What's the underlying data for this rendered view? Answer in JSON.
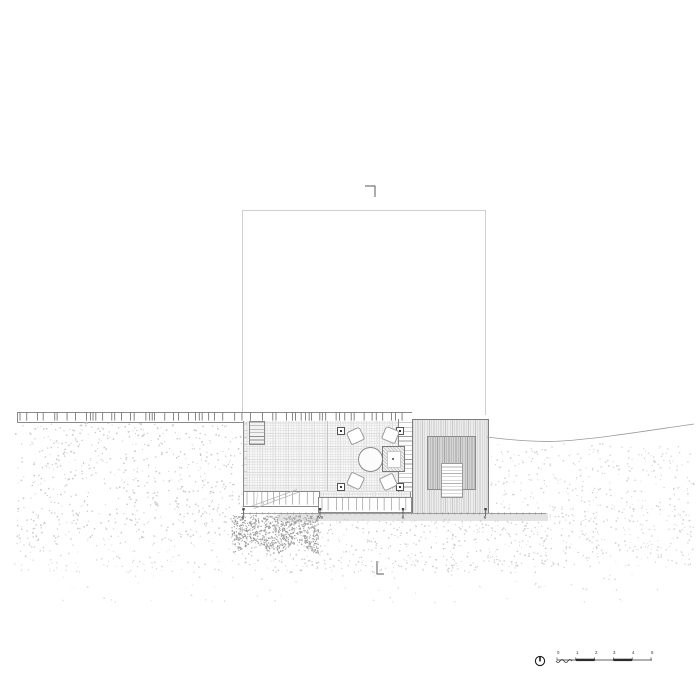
{
  "drawing": {
    "scale_bar": {
      "labels": [
        "0",
        "1",
        "2",
        "3",
        "4",
        "5"
      ]
    },
    "piles": {
      "labels": [
        "B",
        "WB",
        "B",
        "B"
      ]
    },
    "icons": {
      "north_arrow": "circle-with-north-needle",
      "section_marker_top": "corner-bracket-down",
      "section_marker_bottom": "corner-bracket-right"
    },
    "colors": {
      "ink": "#444444",
      "outline_light": "#cfcfcf",
      "line_mid": "#8a8a8a",
      "tick": "#555555",
      "stipple": "#c8c8c8",
      "stipple_dense": "#a2a2a2",
      "strip": "#e3e3e3",
      "scale_ink": "#2c2c2c"
    }
  }
}
